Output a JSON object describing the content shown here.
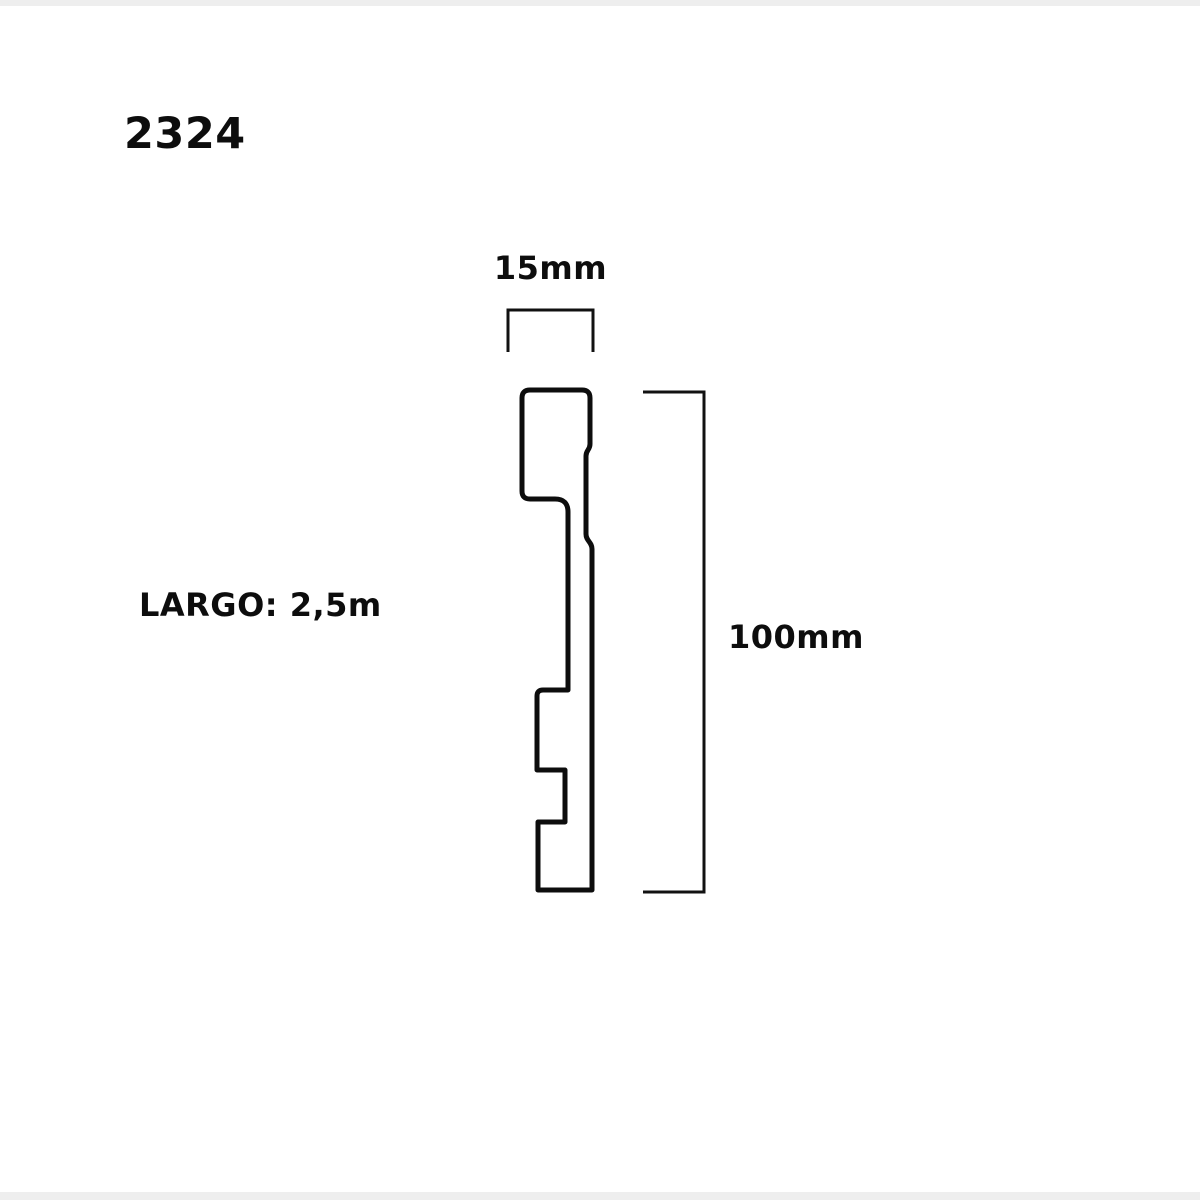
{
  "page": {
    "background_color": "#ffffff",
    "edge_strip_color": "#eeeeee"
  },
  "diagram": {
    "product_code": "2324",
    "line_color": "#0d0d0d",
    "profile_type": "skirting-board-cross-section",
    "dimensions": {
      "width": {
        "label": "15mm"
      },
      "height": {
        "label": "100mm"
      },
      "length": {
        "label": "LARGO: 2,5m"
      }
    }
  }
}
